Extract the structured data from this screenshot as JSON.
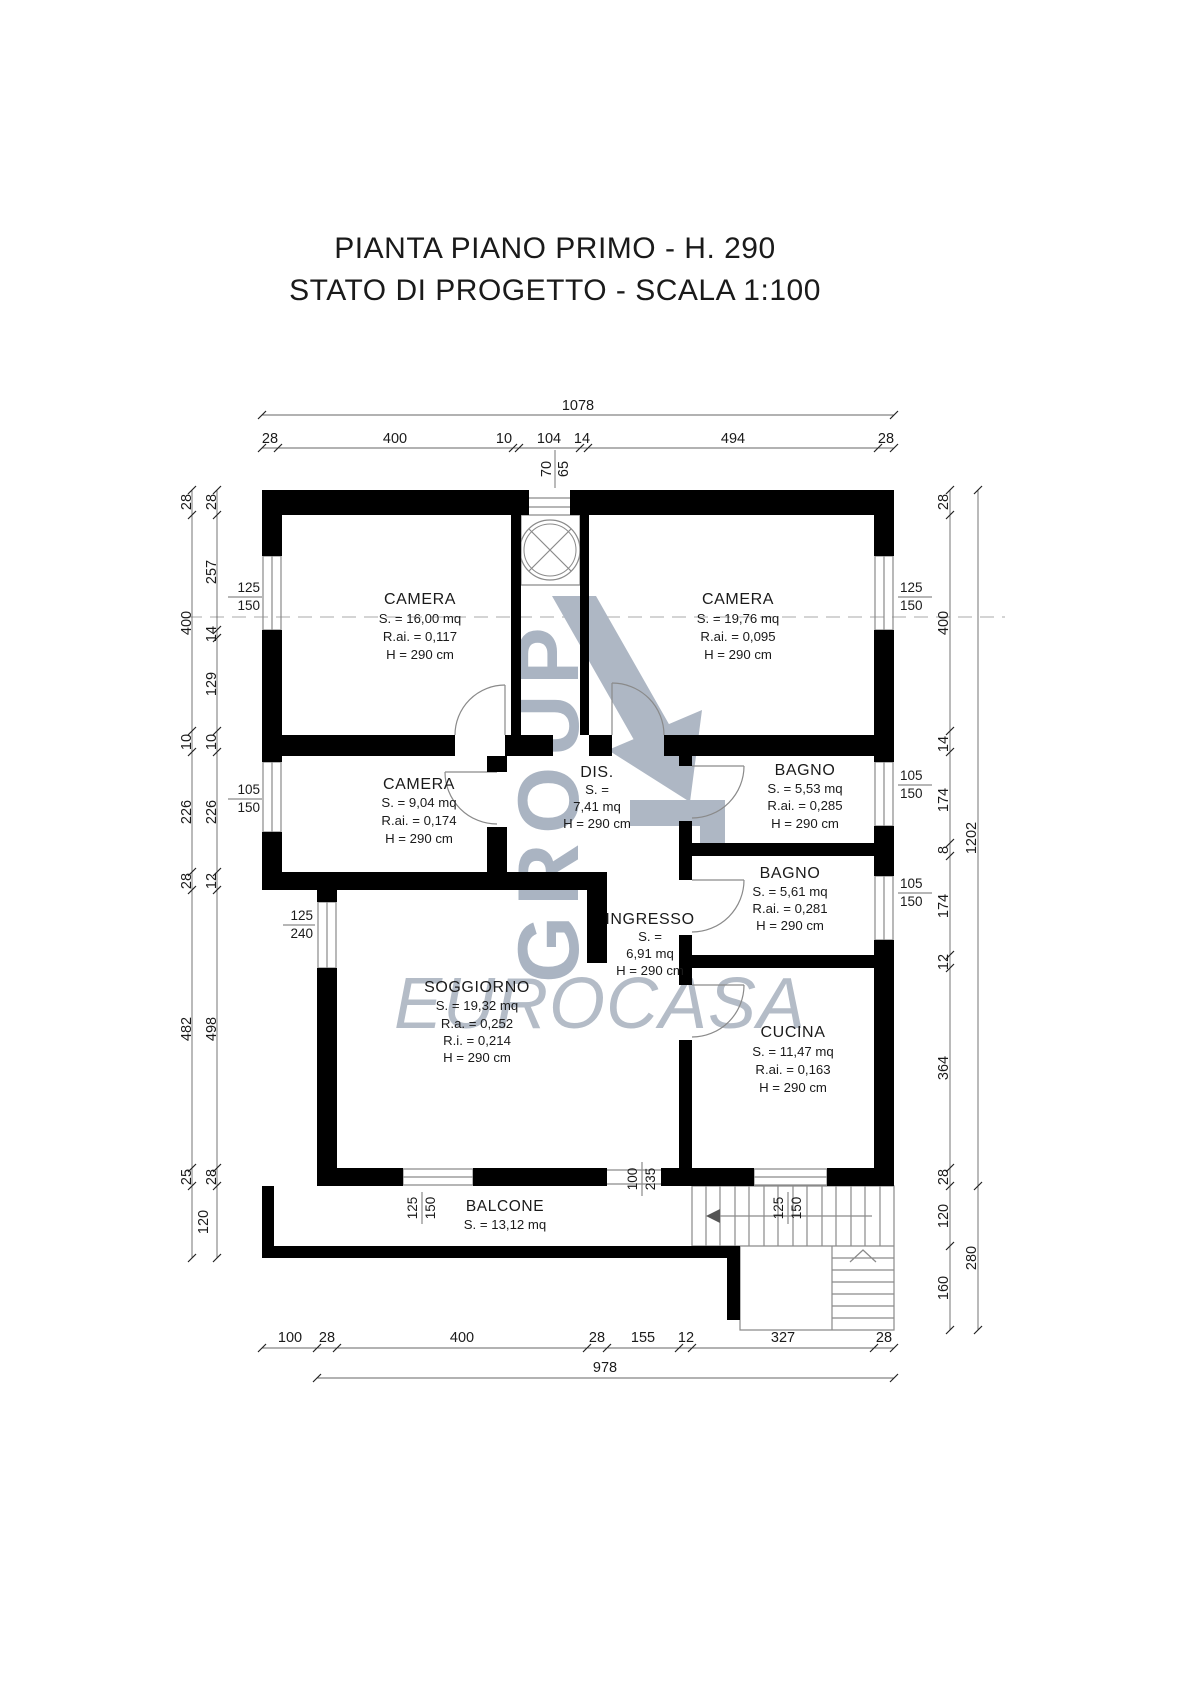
{
  "title": {
    "line1": "PIANTA PIANO PRIMO - H. 290",
    "line2": "STATO DI PROGETTO - SCALA 1:100"
  },
  "watermark": {
    "word": "GROUP",
    "brand": "EUROCASA"
  },
  "rooms": {
    "camera1": {
      "name": "CAMERA",
      "lines": [
        "S. = 16,00 mq",
        "R.ai. = 0,117",
        "H = 290 cm"
      ]
    },
    "camera2": {
      "name": "CAMERA",
      "lines": [
        "S. = 19,76 mq",
        "R.ai. = 0,095",
        "H = 290 cm"
      ]
    },
    "camera3": {
      "name": "CAMERA",
      "lines": [
        "S. = 9,04 mq",
        "R.ai. = 0,174",
        "H = 290 cm"
      ]
    },
    "dis": {
      "name": "DIS.",
      "lines": [
        "S. =",
        "7,41 mq",
        "H = 290 cm"
      ]
    },
    "bagno1": {
      "name": "BAGNO",
      "lines": [
        "S. = 5,53 mq",
        "R.ai. = 0,285",
        "H = 290 cm"
      ]
    },
    "bagno2": {
      "name": "BAGNO",
      "lines": [
        "S. = 5,61 mq",
        "R.ai. = 0,281",
        "H = 290 cm"
      ]
    },
    "ingresso": {
      "name": "INGRESSO",
      "lines": [
        "S. =",
        "6,91 mq",
        "H = 290 cm"
      ]
    },
    "soggiorno": {
      "name": "SOGGIORNO",
      "lines": [
        "S. = 19,32 mq",
        "R.a. = 0,252",
        "R.i. = 0,214",
        "H = 290 cm"
      ]
    },
    "cucina": {
      "name": "CUCINA",
      "lines": [
        "S. = 11,47 mq",
        "R.ai. = 0,163",
        "H = 290 cm"
      ]
    },
    "balcone": {
      "name": "BALCONE",
      "lines": [
        "S. = 13,12 mq"
      ]
    }
  },
  "dims": {
    "top_total": "1078",
    "top": [
      "28",
      "400",
      "10",
      "104",
      "14",
      "494",
      "28"
    ],
    "shaft": [
      "70",
      "65"
    ],
    "left_outer": [
      "28",
      "400",
      "10",
      "226",
      "28",
      "482",
      "25"
    ],
    "left_inner": [
      "28",
      "257",
      "14",
      "129",
      "10",
      "226",
      "12",
      "498",
      "28",
      "120"
    ],
    "right": [
      "28",
      "400",
      "14",
      "174",
      "8",
      "174",
      "12",
      "364",
      "28",
      "120",
      "160"
    ],
    "right_total": "1202",
    "right_lower_total": "280",
    "bottom": [
      "100",
      "28",
      "400",
      "28",
      "155",
      "12",
      "327",
      "28"
    ],
    "bottom_total": "978",
    "windows": {
      "left_top": [
        "125",
        "150"
      ],
      "left_mid": [
        "105",
        "150"
      ],
      "sogg_left": [
        "125",
        "240"
      ],
      "right_top": [
        "125",
        "150"
      ],
      "right_mid": [
        "105",
        "150"
      ],
      "right_low": [
        "105",
        "150"
      ],
      "sogg_bottom": [
        "125",
        "150"
      ],
      "balcony_door": [
        "100",
        "235"
      ],
      "cucina_bottom": [
        "125",
        "150"
      ]
    }
  }
}
